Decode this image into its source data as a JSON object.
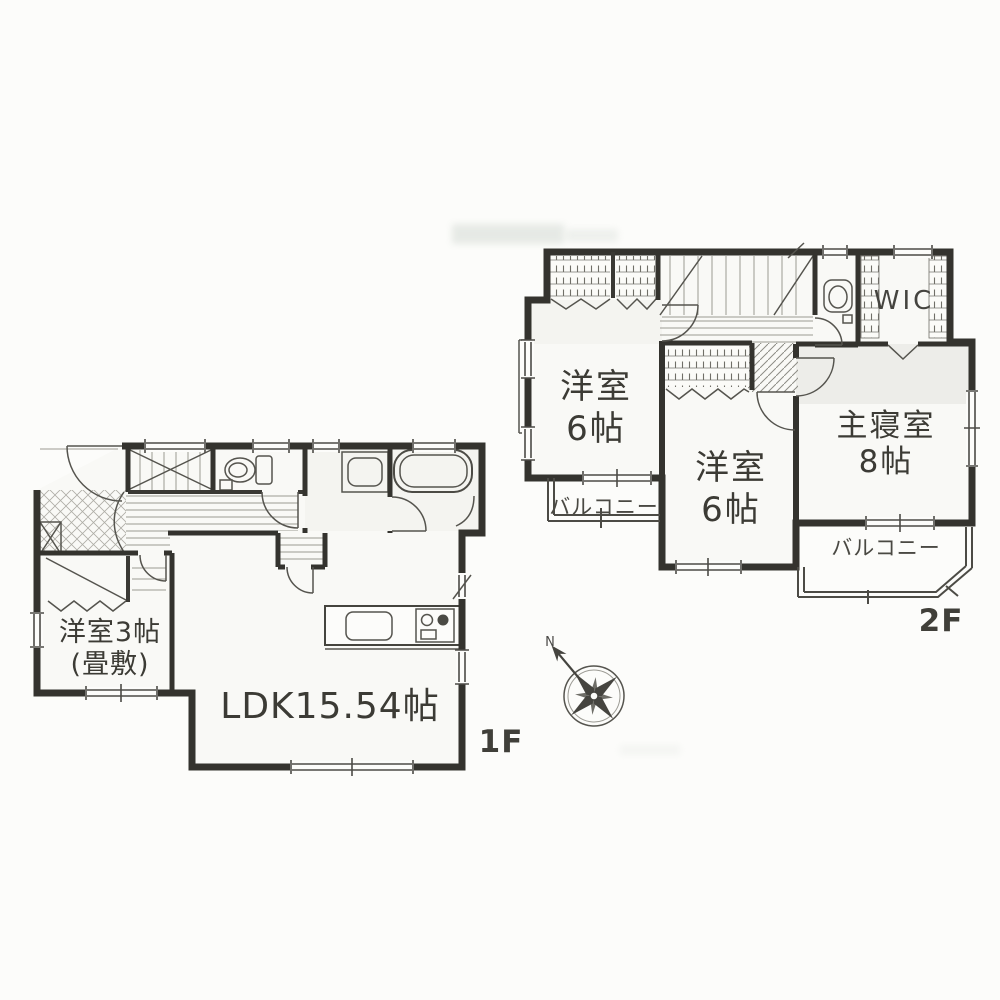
{
  "palette": {
    "wall": "#34332e",
    "thin_line": "#55544e",
    "floor_line": "#9b9a93",
    "text": "#3c3b35",
    "background": "#fcfcfa"
  },
  "floor2": {
    "floor_label": "2F",
    "room_west": {
      "name": "洋室",
      "size": "6帖"
    },
    "room_center": {
      "name": "洋室",
      "size": "6帖"
    },
    "master_bedroom": {
      "name": "主寝室",
      "size": "8帖"
    },
    "wic": {
      "label": "WIC"
    },
    "balcony_west": {
      "label": "バルコニー"
    },
    "balcony_south": {
      "label": "バルコニー"
    }
  },
  "floor1": {
    "floor_label": "1F",
    "ldk": {
      "label": "LDK15.54帖"
    },
    "japanese_room": {
      "name": "洋室3帖",
      "size": "(畳敷)"
    }
  },
  "compass": {
    "north_label": "N"
  }
}
